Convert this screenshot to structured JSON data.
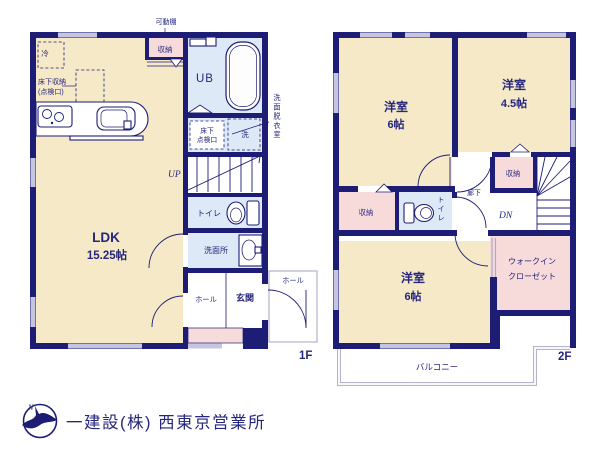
{
  "colors": {
    "wall": "#1d1d76",
    "room": "#f5e9c8",
    "wet": "#dde9f6",
    "storage": "#f7dbdb",
    "window": "#c5c5e0",
    "text": "#26267e",
    "outline_light": "#b2b2cc",
    "footer_text": "#c9c9cf",
    "logo": "#1c1c74"
  },
  "floor1": {
    "label": "1F",
    "ldk": {
      "name": "LDK",
      "area": "15.25帖"
    },
    "kadoudana": "可動棚",
    "shuunou": "収納",
    "rei": "冷",
    "yukashita_shuunou_l1": "床下収納",
    "yukashita_shuunou_l2": "(点検口)",
    "ub": "UB",
    "senmen_datsui": "洗面脱衣室",
    "yukashita_tenken_l1": "床下",
    "yukashita_tenken_l2": "点検口",
    "sentaku": "洗",
    "up": "UP",
    "toire": "トイレ",
    "senmenjo": "洗面所",
    "hall": "ホール",
    "genkan": "玄関",
    "porch_hall": "ホール"
  },
  "floor2": {
    "label": "2F",
    "room_nw": {
      "name": "洋室",
      "area": "6帖"
    },
    "room_ne": {
      "name": "洋室",
      "area": "4.5帖"
    },
    "room_s": {
      "name": "洋室",
      "area": "6帖"
    },
    "shuunou_left": "収納",
    "toire": "トイレ",
    "rouka": "廊下",
    "shuunou_mid": "収納",
    "dn": "DN",
    "wic_l1": "ウォークイン",
    "wic_l2": "クローゼット",
    "balcony": "バルコニー"
  },
  "footer": {
    "logo_letter": "N",
    "company": "一建設(株) 西東京営業所"
  }
}
